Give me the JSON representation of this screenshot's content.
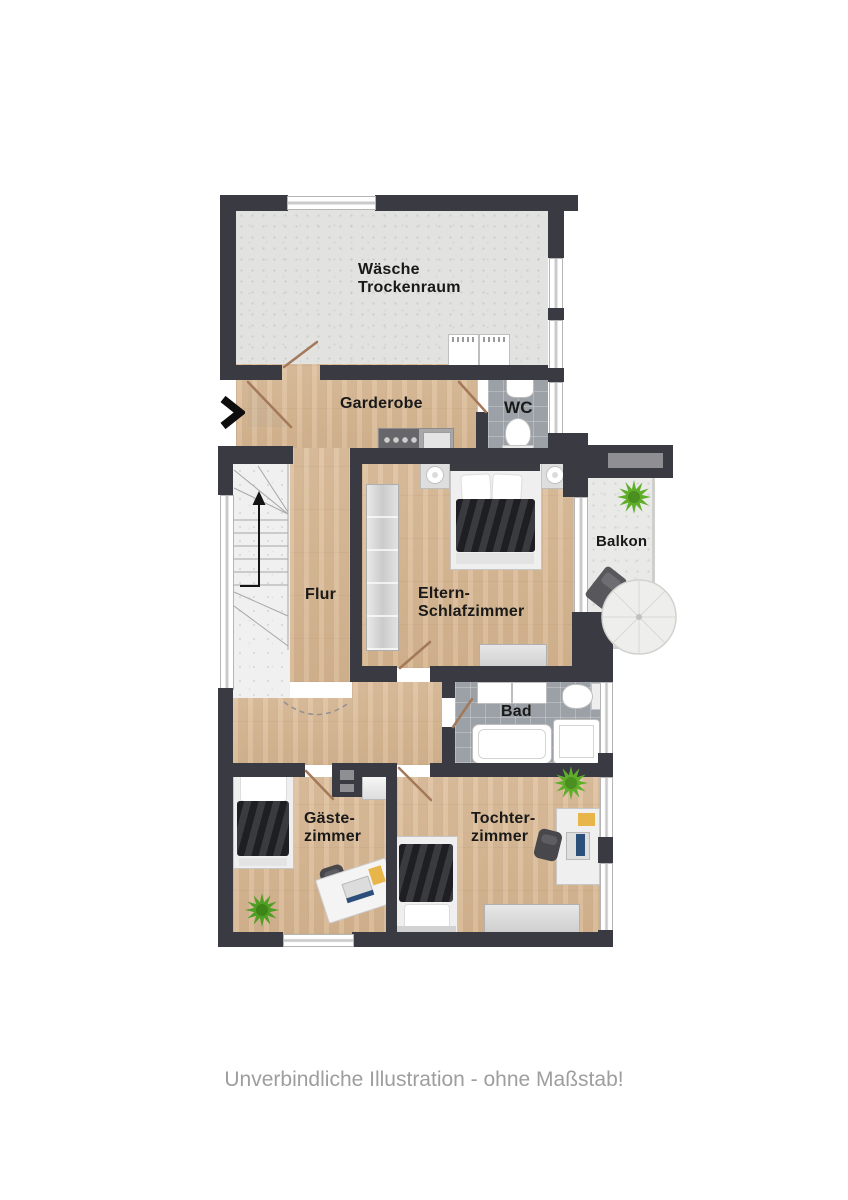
{
  "caption": "Unverbindliche Illustration - ohne Maßstab!",
  "icons": {
    "entrance_arrow": "chevron-right"
  },
  "rooms": {
    "laundry": {
      "line1": "Wäsche",
      "line2": "Trockenraum"
    },
    "wardrobe_hall": {
      "label": "Garderobe"
    },
    "wc": {
      "label": "WC"
    },
    "hallway": {
      "label": "Flur"
    },
    "parents_bedroom": {
      "line1": "Eltern-",
      "line2": "Schlafzimmer"
    },
    "balcony": {
      "label": "Balkon"
    },
    "bathroom": {
      "label": "Bad"
    },
    "guest_room": {
      "line1": "Gäste-",
      "line2": "zimmer"
    },
    "daughter_room": {
      "line1": "Tochter-",
      "line2": "zimmer"
    }
  },
  "colors": {
    "wall": "#3a3a42",
    "wood_floor": "#d9b995",
    "tile_floor": "#9ba1a6",
    "laundry_floor": "#e2e2e1",
    "stair_floor": "#f0f0f0",
    "balcony_floor": "#e9e9e7",
    "plant_green": "#5fae2a",
    "desk_pad_yellow": "#e8b54a",
    "door_leaf": "#a3795a"
  }
}
